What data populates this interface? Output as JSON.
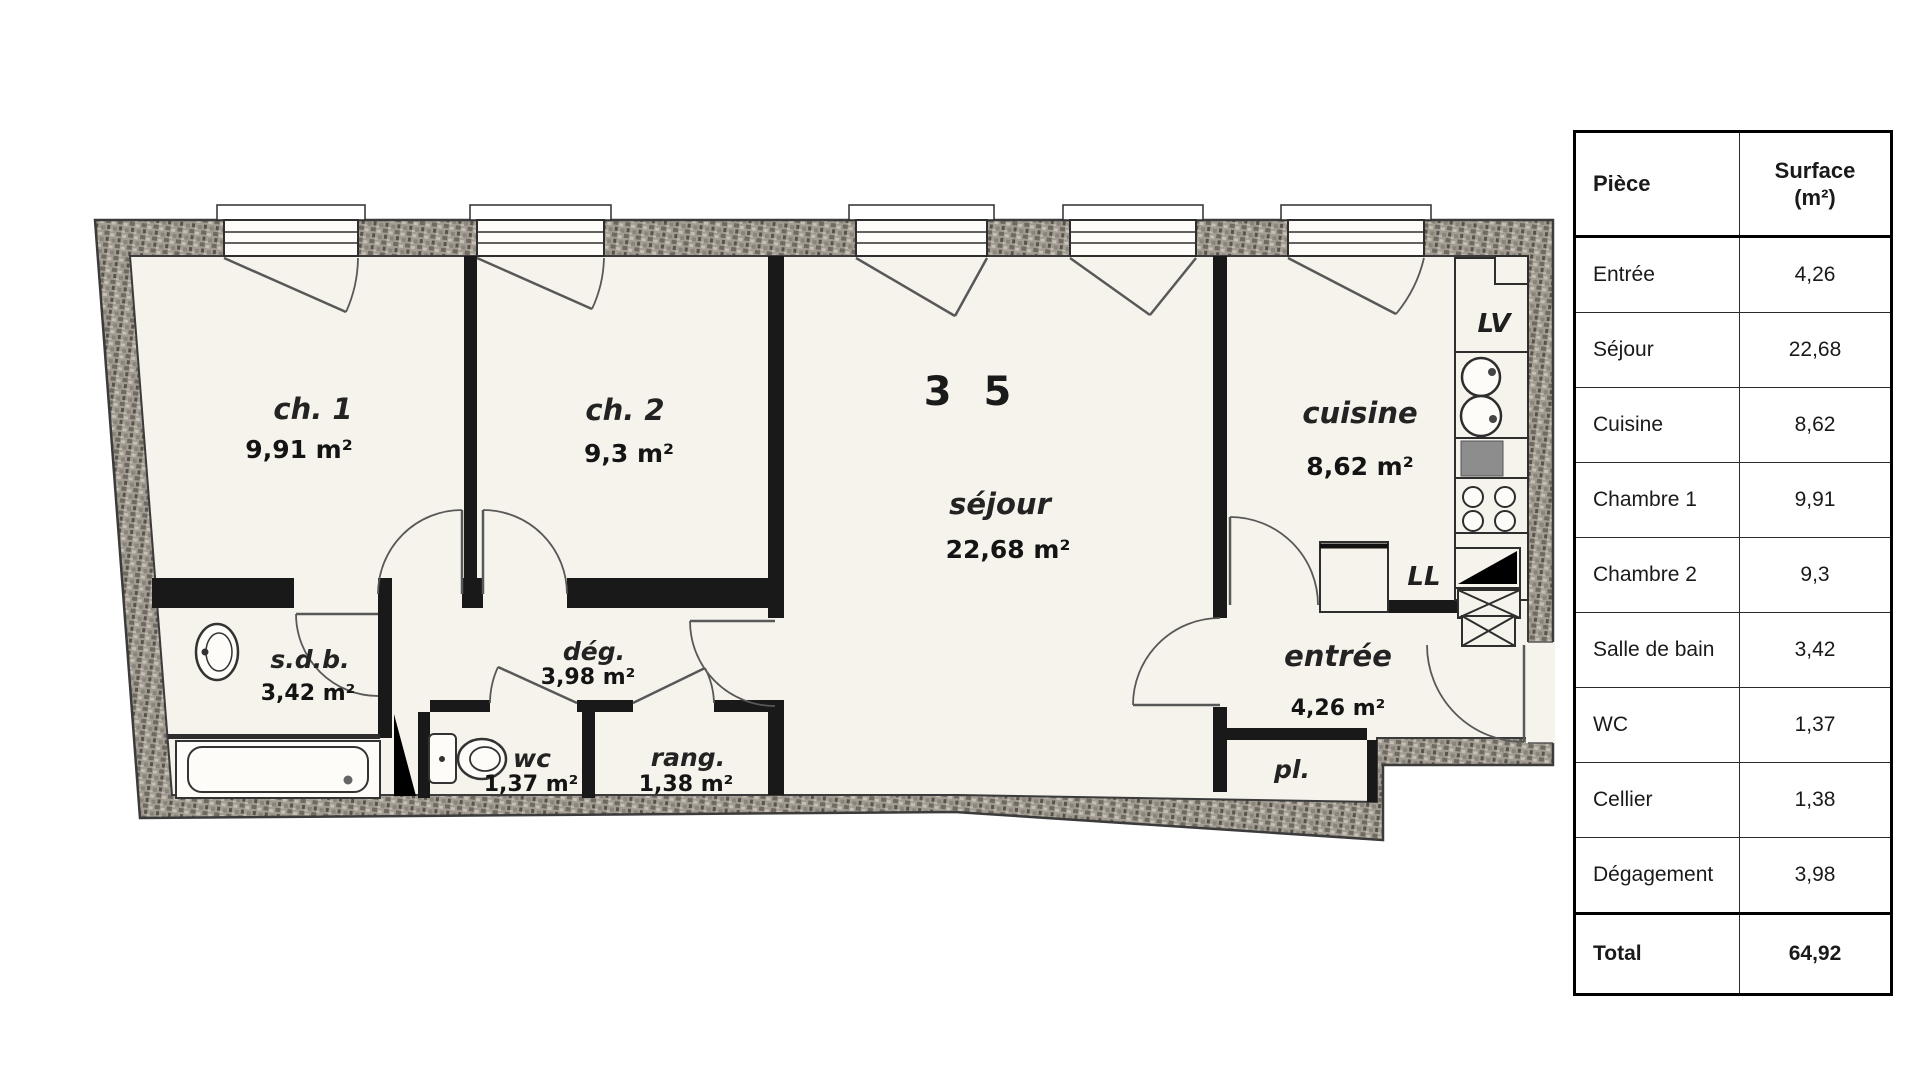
{
  "colors": {
    "paper": "#f6f3ec",
    "ink": "#1c1c1c",
    "wall_dark": "#191919"
  },
  "floor_plan": {
    "unit_number": "3 5",
    "rooms": {
      "ch1": {
        "label": "ch. 1",
        "area": "9,91 m²"
      },
      "ch2": {
        "label": "ch. 2",
        "area": "9,3 m²"
      },
      "sejour": {
        "label": "séjour",
        "area": "22,68 m²"
      },
      "cuisine": {
        "label": "cuisine",
        "area": "8,62 m²"
      },
      "sdb": {
        "label": "s.d.b.",
        "area": "3,42 m²"
      },
      "deg": {
        "label": "dég.",
        "area": "3,98 m²"
      },
      "wc": {
        "label": "wc",
        "area": "1,37 m²"
      },
      "rang": {
        "label": "rang.",
        "area": "1,38 m²"
      },
      "entree": {
        "label": "entrée",
        "area": "4,26 m²"
      },
      "placard": {
        "label": "pl."
      }
    },
    "appliances": {
      "dishwasher": "LV",
      "washer": "LL"
    }
  },
  "table": {
    "col1_header": "Pièce",
    "col2_header": "Surface\n(m²)",
    "rows": [
      {
        "piece": "Entrée",
        "surface": "4,26"
      },
      {
        "piece": "Séjour",
        "surface": "22,68"
      },
      {
        "piece": "Cuisine",
        "surface": "8,62"
      },
      {
        "piece": "Chambre 1",
        "surface": "9,91"
      },
      {
        "piece": "Chambre 2",
        "surface": "9,3"
      },
      {
        "piece": "Salle de bain",
        "surface": "3,42"
      },
      {
        "piece": "WC",
        "surface": "1,37"
      },
      {
        "piece": "Cellier",
        "surface": "1,38"
      },
      {
        "piece": "Dégagement",
        "surface": "3,98"
      }
    ],
    "total": {
      "piece": "Total",
      "surface": "64,92"
    }
  }
}
